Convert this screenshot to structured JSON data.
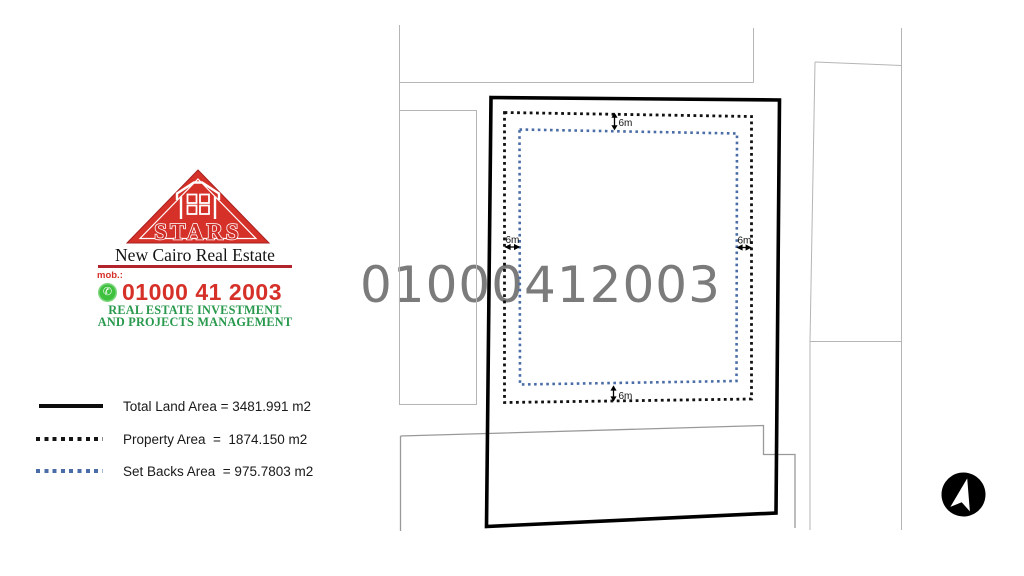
{
  "logo": {
    "brand": "STARS",
    "subtitle": "New Cairo Real Estate",
    "mob_label": "mob.:",
    "phone": "01000 41 2003",
    "tagline1": "REAL ESTATE INVESTMENT",
    "tagline2": "AND PROJECTS MANAGEMENT"
  },
  "watermark": "01000412003",
  "legend": {
    "items": [
      {
        "label": "Total Land Area = 3481.991 m2",
        "style": "solid-black"
      },
      {
        "label": "Property Area  =  1874.150 m2",
        "style": "dotted-black"
      },
      {
        "label": "Set Backs Area  = 975.7803 m2",
        "style": "dotted-blue"
      }
    ]
  },
  "plan": {
    "setback_top": "6m",
    "setback_bottom": "6m",
    "setback_left": "6m",
    "setback_right": "6m"
  },
  "colors": {
    "brand_red": "#d63129",
    "divider_red": "#b2232b",
    "brand_green": "#28994d",
    "whatsapp_green": "#3ec13e",
    "setback_blue": "#4a6da7",
    "watermark_gray": "#7b7b7b",
    "neighbor_line_gray": "#b5b5b5"
  }
}
